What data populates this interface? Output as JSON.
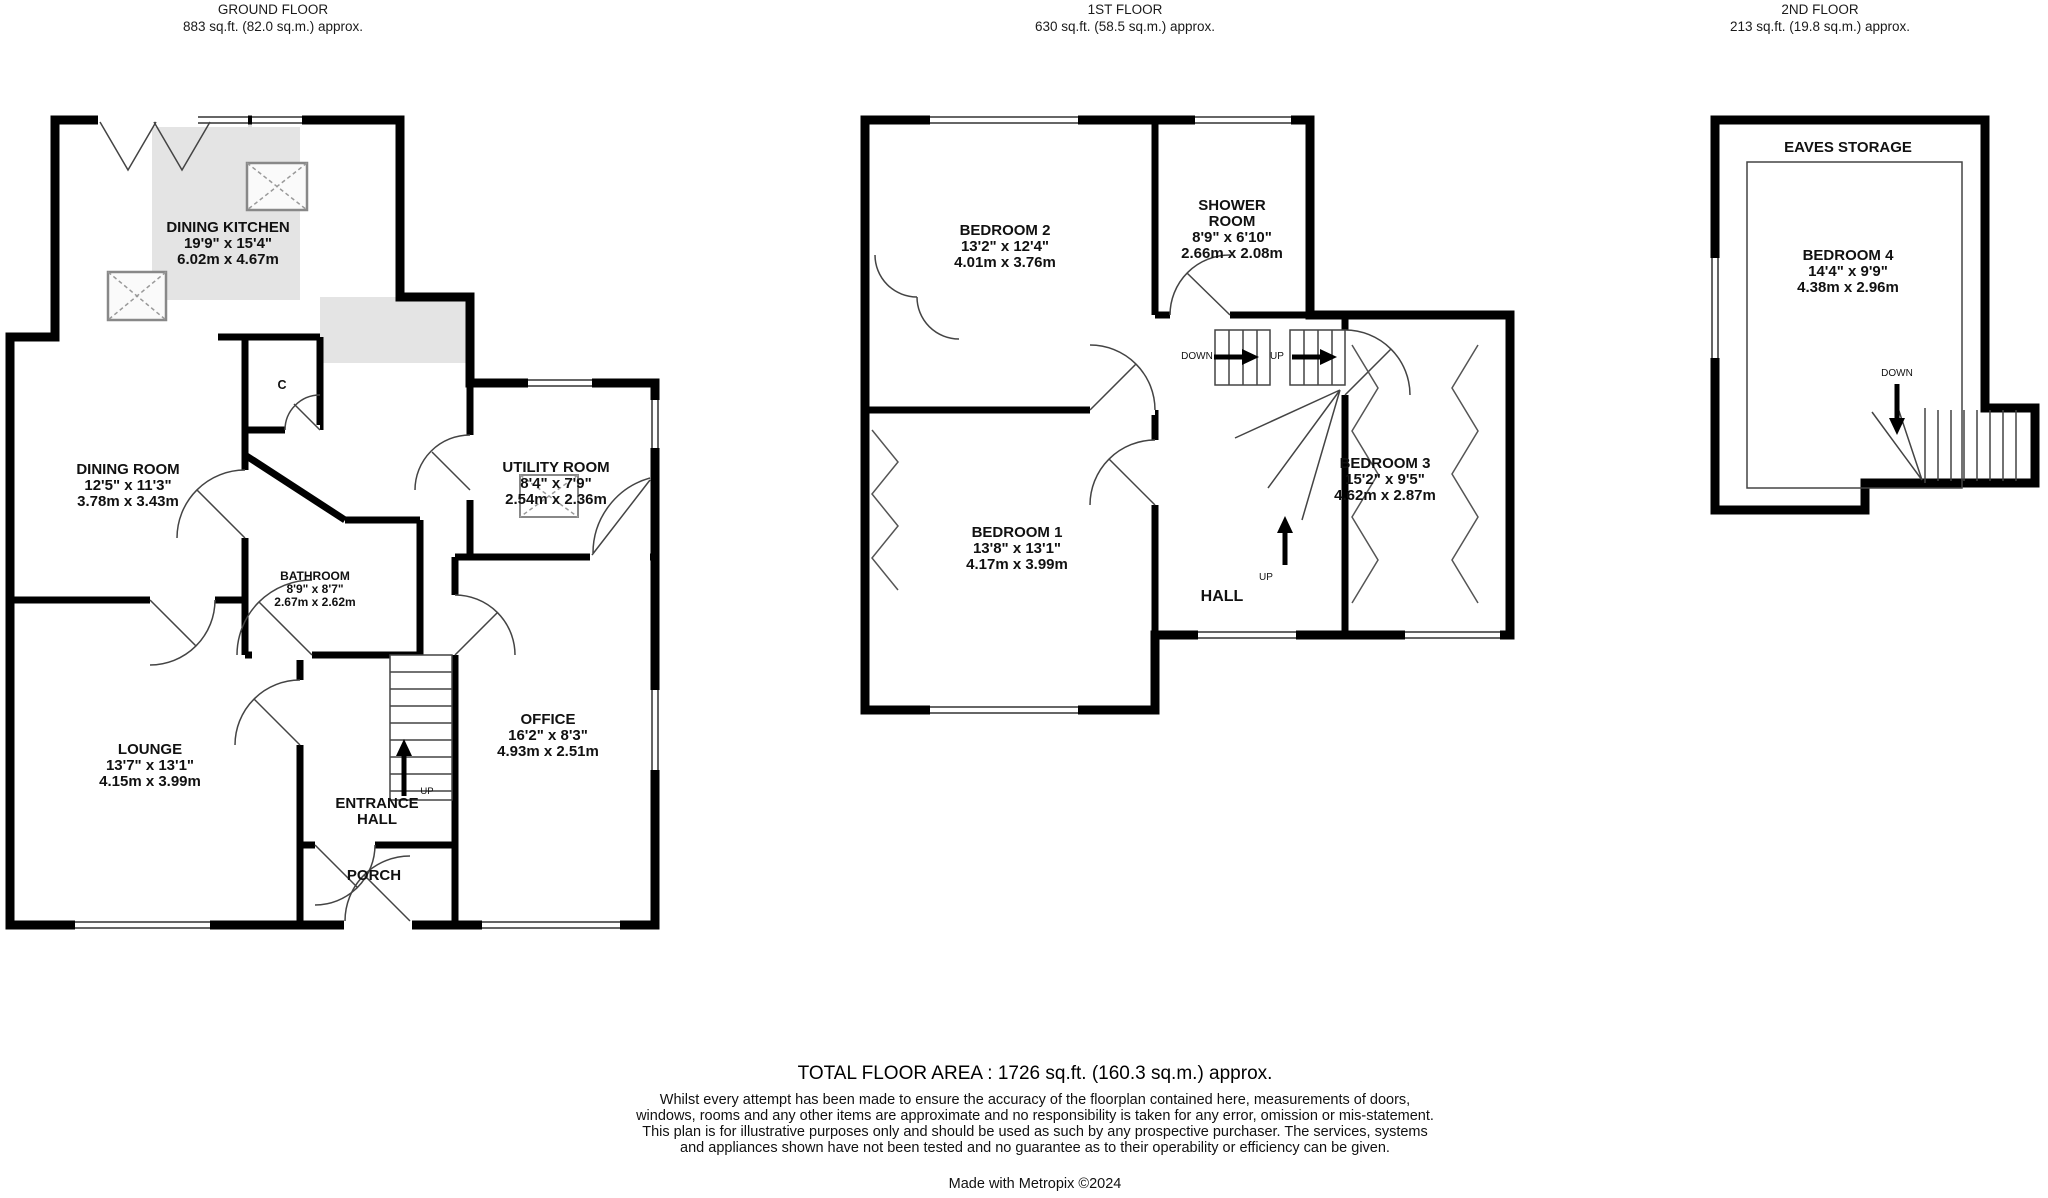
{
  "floors": {
    "ground": {
      "title": "GROUND FLOOR",
      "area": "883 sq.ft. (82.0 sq.m.) approx."
    },
    "first": {
      "title": "1ST FLOOR",
      "area": "630 sq.ft. (58.5 sq.m.) approx."
    },
    "second": {
      "title": "2ND FLOOR",
      "area": "213 sq.ft. (19.8 sq.m.) approx."
    }
  },
  "rooms": {
    "dining_kitchen": {
      "name": "DINING KITCHEN",
      "imperial": "19'9\"  x 15'4\"",
      "metric": "6.02m  x 4.67m"
    },
    "dining_room": {
      "name": "DINING ROOM",
      "imperial": "12'5\"  x 11'3\"",
      "metric": "3.78m  x 3.43m"
    },
    "utility_room": {
      "name": "UTILITY ROOM",
      "imperial": "8'4\"  x 7'9\"",
      "metric": "2.54m  x 2.36m"
    },
    "bathroom": {
      "name": "BATHROOM",
      "imperial": "8'9\"  x 8'7\"",
      "metric": "2.67m  x 2.62m"
    },
    "lounge": {
      "name": "LOUNGE",
      "imperial": "13'7\"  x 13'1\"",
      "metric": "4.15m  x 3.99m"
    },
    "office": {
      "name": "OFFICE",
      "imperial": "16'2\"  x 8'3\"",
      "metric": "4.93m  x 2.51m"
    },
    "entrance_hall": {
      "name": "ENTRANCE\nHALL"
    },
    "porch": {
      "name": "PORCH"
    },
    "bedroom_1": {
      "name": "BEDROOM 1",
      "imperial": "13'8\"  x 13'1\"",
      "metric": "4.17m  x 3.99m"
    },
    "bedroom_2": {
      "name": "BEDROOM 2",
      "imperial": "13'2\"  x 12'4\"",
      "metric": "4.01m  x 3.76m"
    },
    "bedroom_3": {
      "name": "BEDROOM 3",
      "imperial": "15'2\"  x 9'5\"",
      "metric": "4.62m  x 2.87m"
    },
    "bedroom_4": {
      "name": "BEDROOM 4",
      "imperial": "14'4\"  x 9'9\"",
      "metric": "4.38m  x 2.96m"
    },
    "shower_room": {
      "name": "SHOWER\nROOM",
      "imperial": "8'9\"  x 6'10\"",
      "metric": "2.66m  x 2.08m"
    },
    "hall": {
      "name": "HALL"
    },
    "eaves_storage": {
      "name": "EAVES STORAGE"
    }
  },
  "labels": {
    "up": "UP",
    "down": "DOWN",
    "cupboard": "C"
  },
  "colors": {
    "wall": "#000000",
    "shading": "#e4e4e4",
    "text": "#111111"
  },
  "footer": {
    "total_area": "TOTAL FLOOR AREA : 1726 sq.ft. (160.3 sq.m.) approx.",
    "disclaimer": "Whilst every attempt has been made to ensure the accuracy of the floorplan contained here, measurements of doors, windows, rooms and any other items are approximate and no responsibility is taken for any error, omission or mis-statement. This plan is for illustrative purposes only and should be used as such by any prospective purchaser. The services, systems and appliances shown have not been tested and no guarantee as to their operability or efficiency can be given.",
    "credit": "Made with Metropix ©2024"
  }
}
